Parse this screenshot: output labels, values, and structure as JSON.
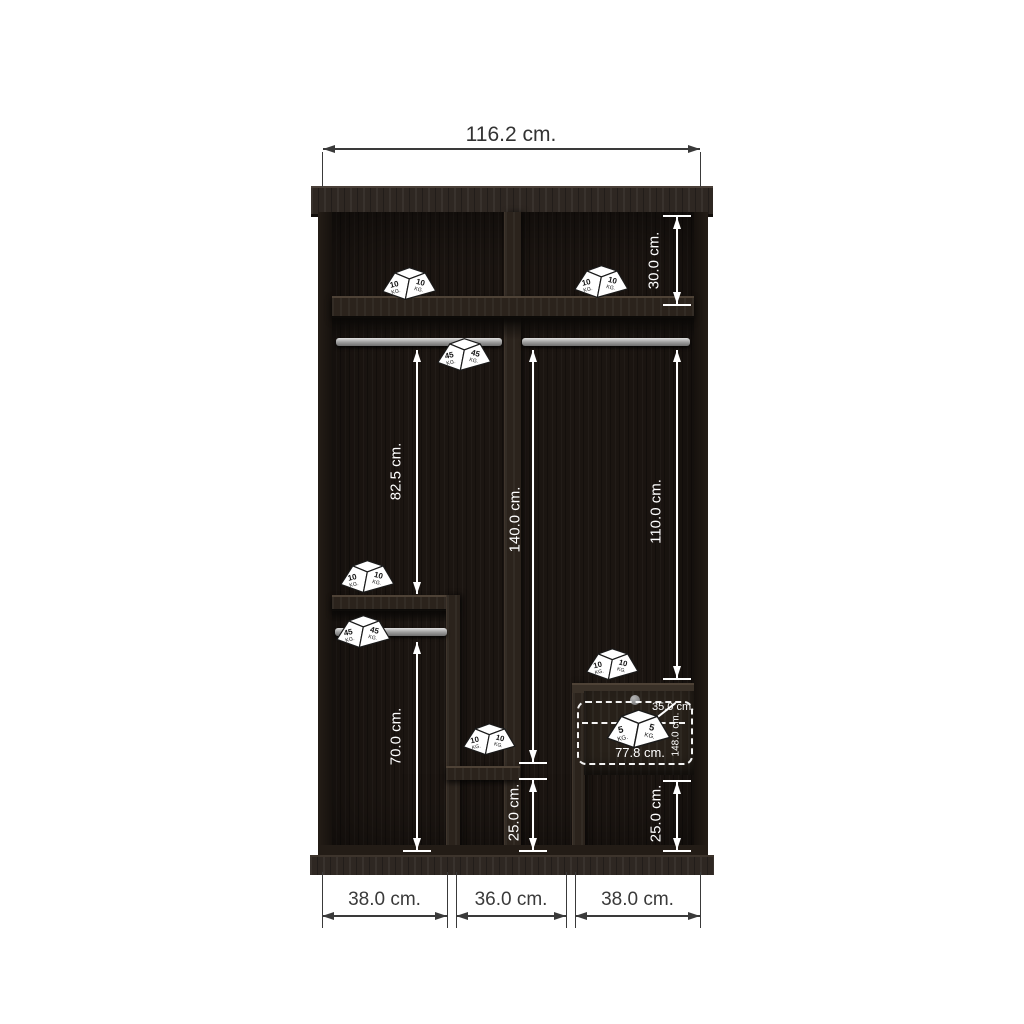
{
  "diagram_type": "wardrobe-interior-dimension-drawing",
  "dimensions": {
    "overall_width": "116.2 cm.",
    "top_shelf_height": "30.0 cm.",
    "left_upper_hang_height": "82.5 cm.",
    "middle_hang_height": "140.0 cm.",
    "right_hang_height": "110.0 cm.",
    "left_lower_hang_height": "70.0 cm.",
    "middle_bottom_clearance": "25.0 cm.",
    "right_bottom_clearance": "25.0 cm.",
    "bottom_left_width": "38.0 cm.",
    "bottom_middle_width": "36.0 cm.",
    "bottom_right_width": "38.0 cm.",
    "drawer_depth": "35.0 cm.",
    "drawer_width": "77.8 cm.",
    "drawer_height": "148.0 cm."
  },
  "weights": [
    {
      "id": "weight-top-left-shelf",
      "value": "10",
      "unit": "KG."
    },
    {
      "id": "weight-top-right-shelf",
      "value": "10",
      "unit": "KG."
    },
    {
      "id": "weight-upper-rail",
      "value": "45",
      "unit": "KG."
    },
    {
      "id": "weight-left-mid-shelf",
      "value": "10",
      "unit": "KG."
    },
    {
      "id": "weight-left-lower-rail",
      "value": "45",
      "unit": "KG."
    },
    {
      "id": "weight-middle-shelf",
      "value": "10",
      "unit": "KG."
    },
    {
      "id": "weight-drawer-top",
      "value": "10",
      "unit": "KG."
    },
    {
      "id": "weight-drawer-inside",
      "value": "5",
      "unit": "KG."
    }
  ],
  "colors": {
    "background": "#ffffff",
    "wood_dark": "#1b1511",
    "wood_panel": "#2b231c",
    "rail_metal": "#b9b9b9",
    "dim_inside": "#ffffff",
    "dim_outside": "#333333",
    "weight_fill": "#ffffff",
    "weight_outline": "#1a1a1a",
    "knob": "#8f8f8f"
  }
}
